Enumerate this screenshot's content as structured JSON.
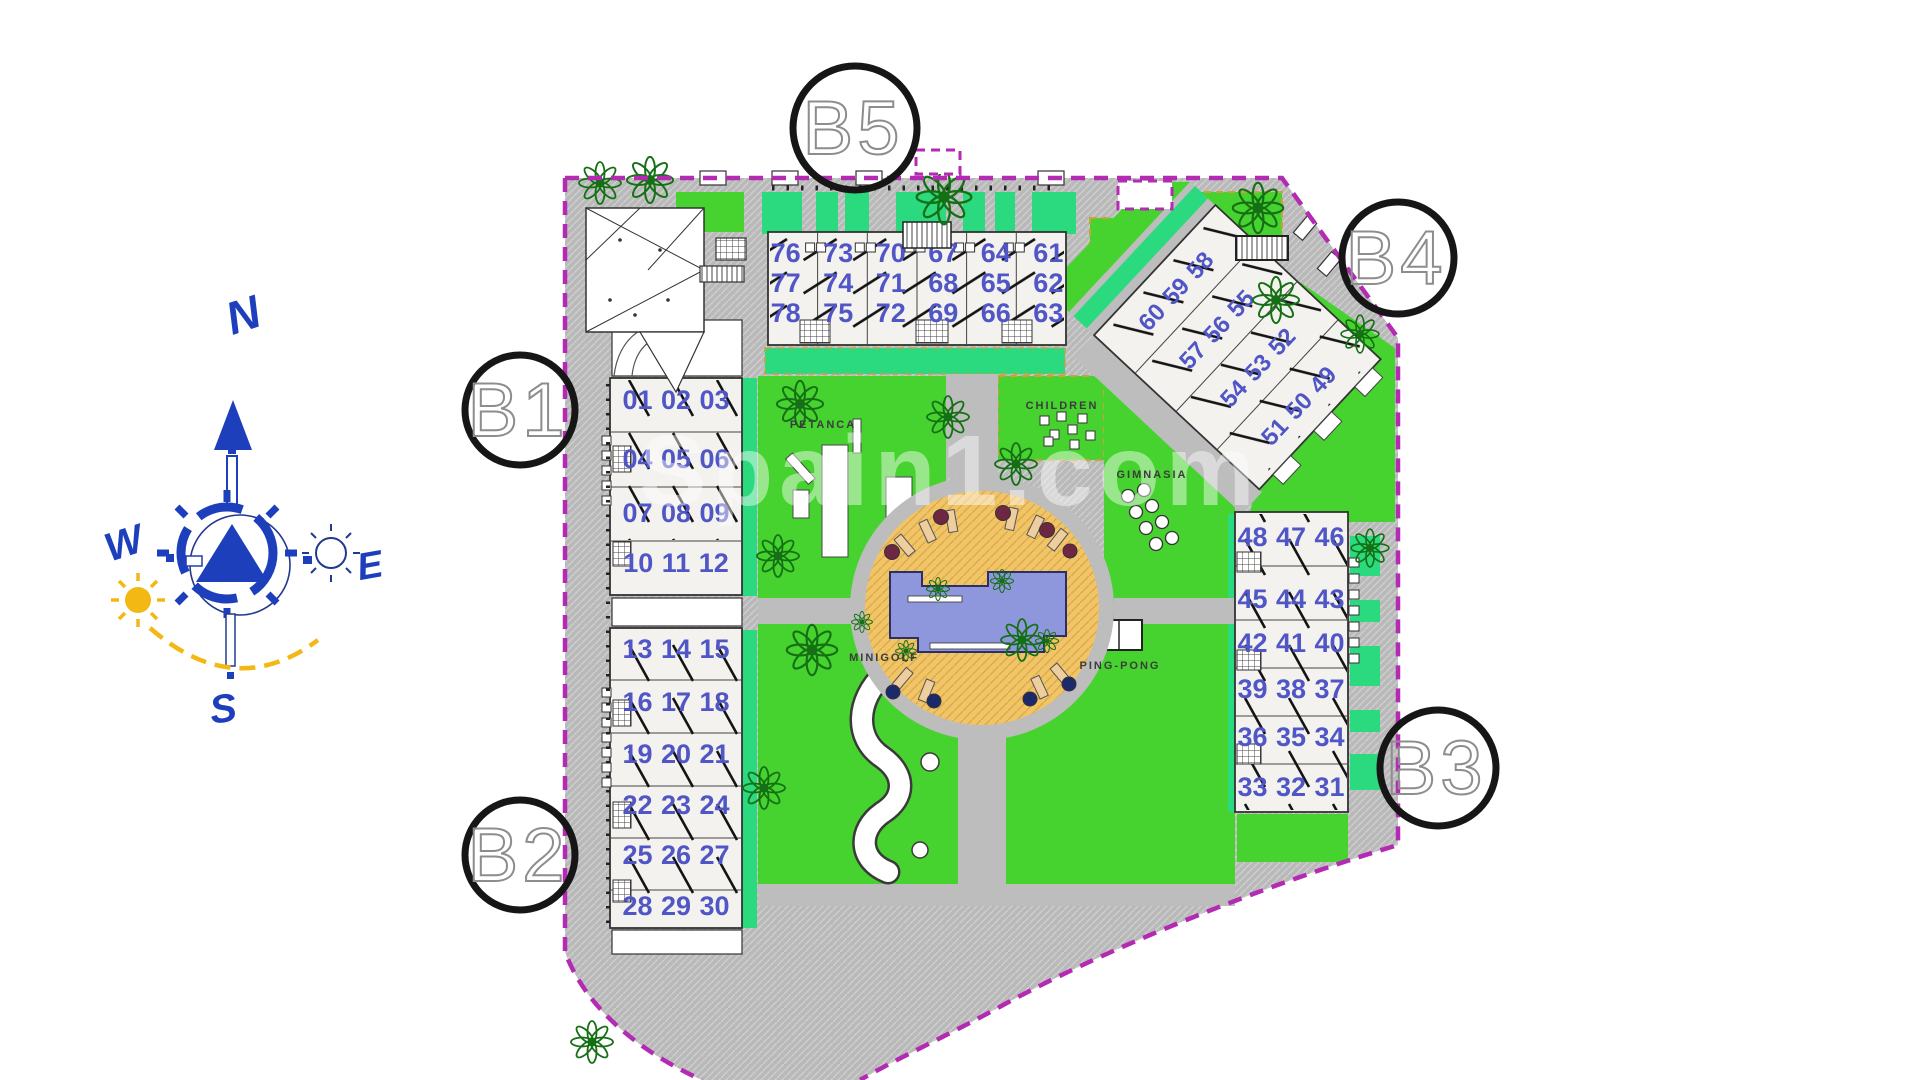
{
  "watermark": {
    "text": "Spain1.com"
  },
  "compass": {
    "n": "N",
    "s": "S",
    "e": "E",
    "w": "W"
  },
  "labels": {
    "blocks": {
      "b1": "B1",
      "b2": "B2",
      "b3": "B3",
      "b4": "B4",
      "b5": "B5"
    },
    "amenities": {
      "petanca": "PETANCA",
      "children": "CHILDREN",
      "gimnasia": "GIMNASIA",
      "minigolf": "MINIGOLF",
      "pingpong": "PING-PONG"
    }
  },
  "units": {
    "b5_rows": [
      [
        "76",
        "73",
        "70",
        "67",
        "64",
        "61"
      ],
      [
        "77",
        "74",
        "71",
        "68",
        "65",
        "62"
      ],
      [
        "78",
        "75",
        "72",
        "69",
        "66",
        "63"
      ]
    ],
    "b4_rows": [
      [
        "60",
        "59",
        "58"
      ],
      [
        "57",
        "56",
        "55"
      ],
      [
        "54",
        "53",
        "52"
      ],
      [
        "51",
        "50",
        "49"
      ]
    ],
    "b1_rows": [
      [
        "01",
        "02",
        "03"
      ],
      [
        "04",
        "05",
        "06"
      ],
      [
        "07",
        "08",
        "09"
      ],
      [
        "10",
        "11",
        "12"
      ]
    ],
    "b2_rows": [
      [
        "13",
        "14",
        "15"
      ],
      [
        "16",
        "17",
        "18"
      ],
      [
        "19",
        "20",
        "21"
      ],
      [
        "22",
        "23",
        "24"
      ],
      [
        "25",
        "26",
        "27"
      ],
      [
        "28",
        "29",
        "30"
      ]
    ],
    "b3_rows": [
      [
        "48",
        "47",
        "46"
      ],
      [
        "45",
        "44",
        "43"
      ],
      [
        "42",
        "41",
        "40"
      ],
      [
        "39",
        "38",
        "37"
      ],
      [
        "36",
        "35",
        "34"
      ],
      [
        "33",
        "32",
        "31"
      ]
    ]
  },
  "colors": {
    "boundary": "#b32ab3",
    "road": "#b9b9b9",
    "lawn": "#47d32f",
    "planter": "#2bd97e",
    "tree": "#2f9e2f",
    "building": "#f4f2ee",
    "unit_numbers": "#5056c6",
    "pool_deck": "#f1c566",
    "pool_water": "#8f97dc",
    "compass_blue": "#1d3fbb",
    "sun_yellow": "#f3b813"
  }
}
